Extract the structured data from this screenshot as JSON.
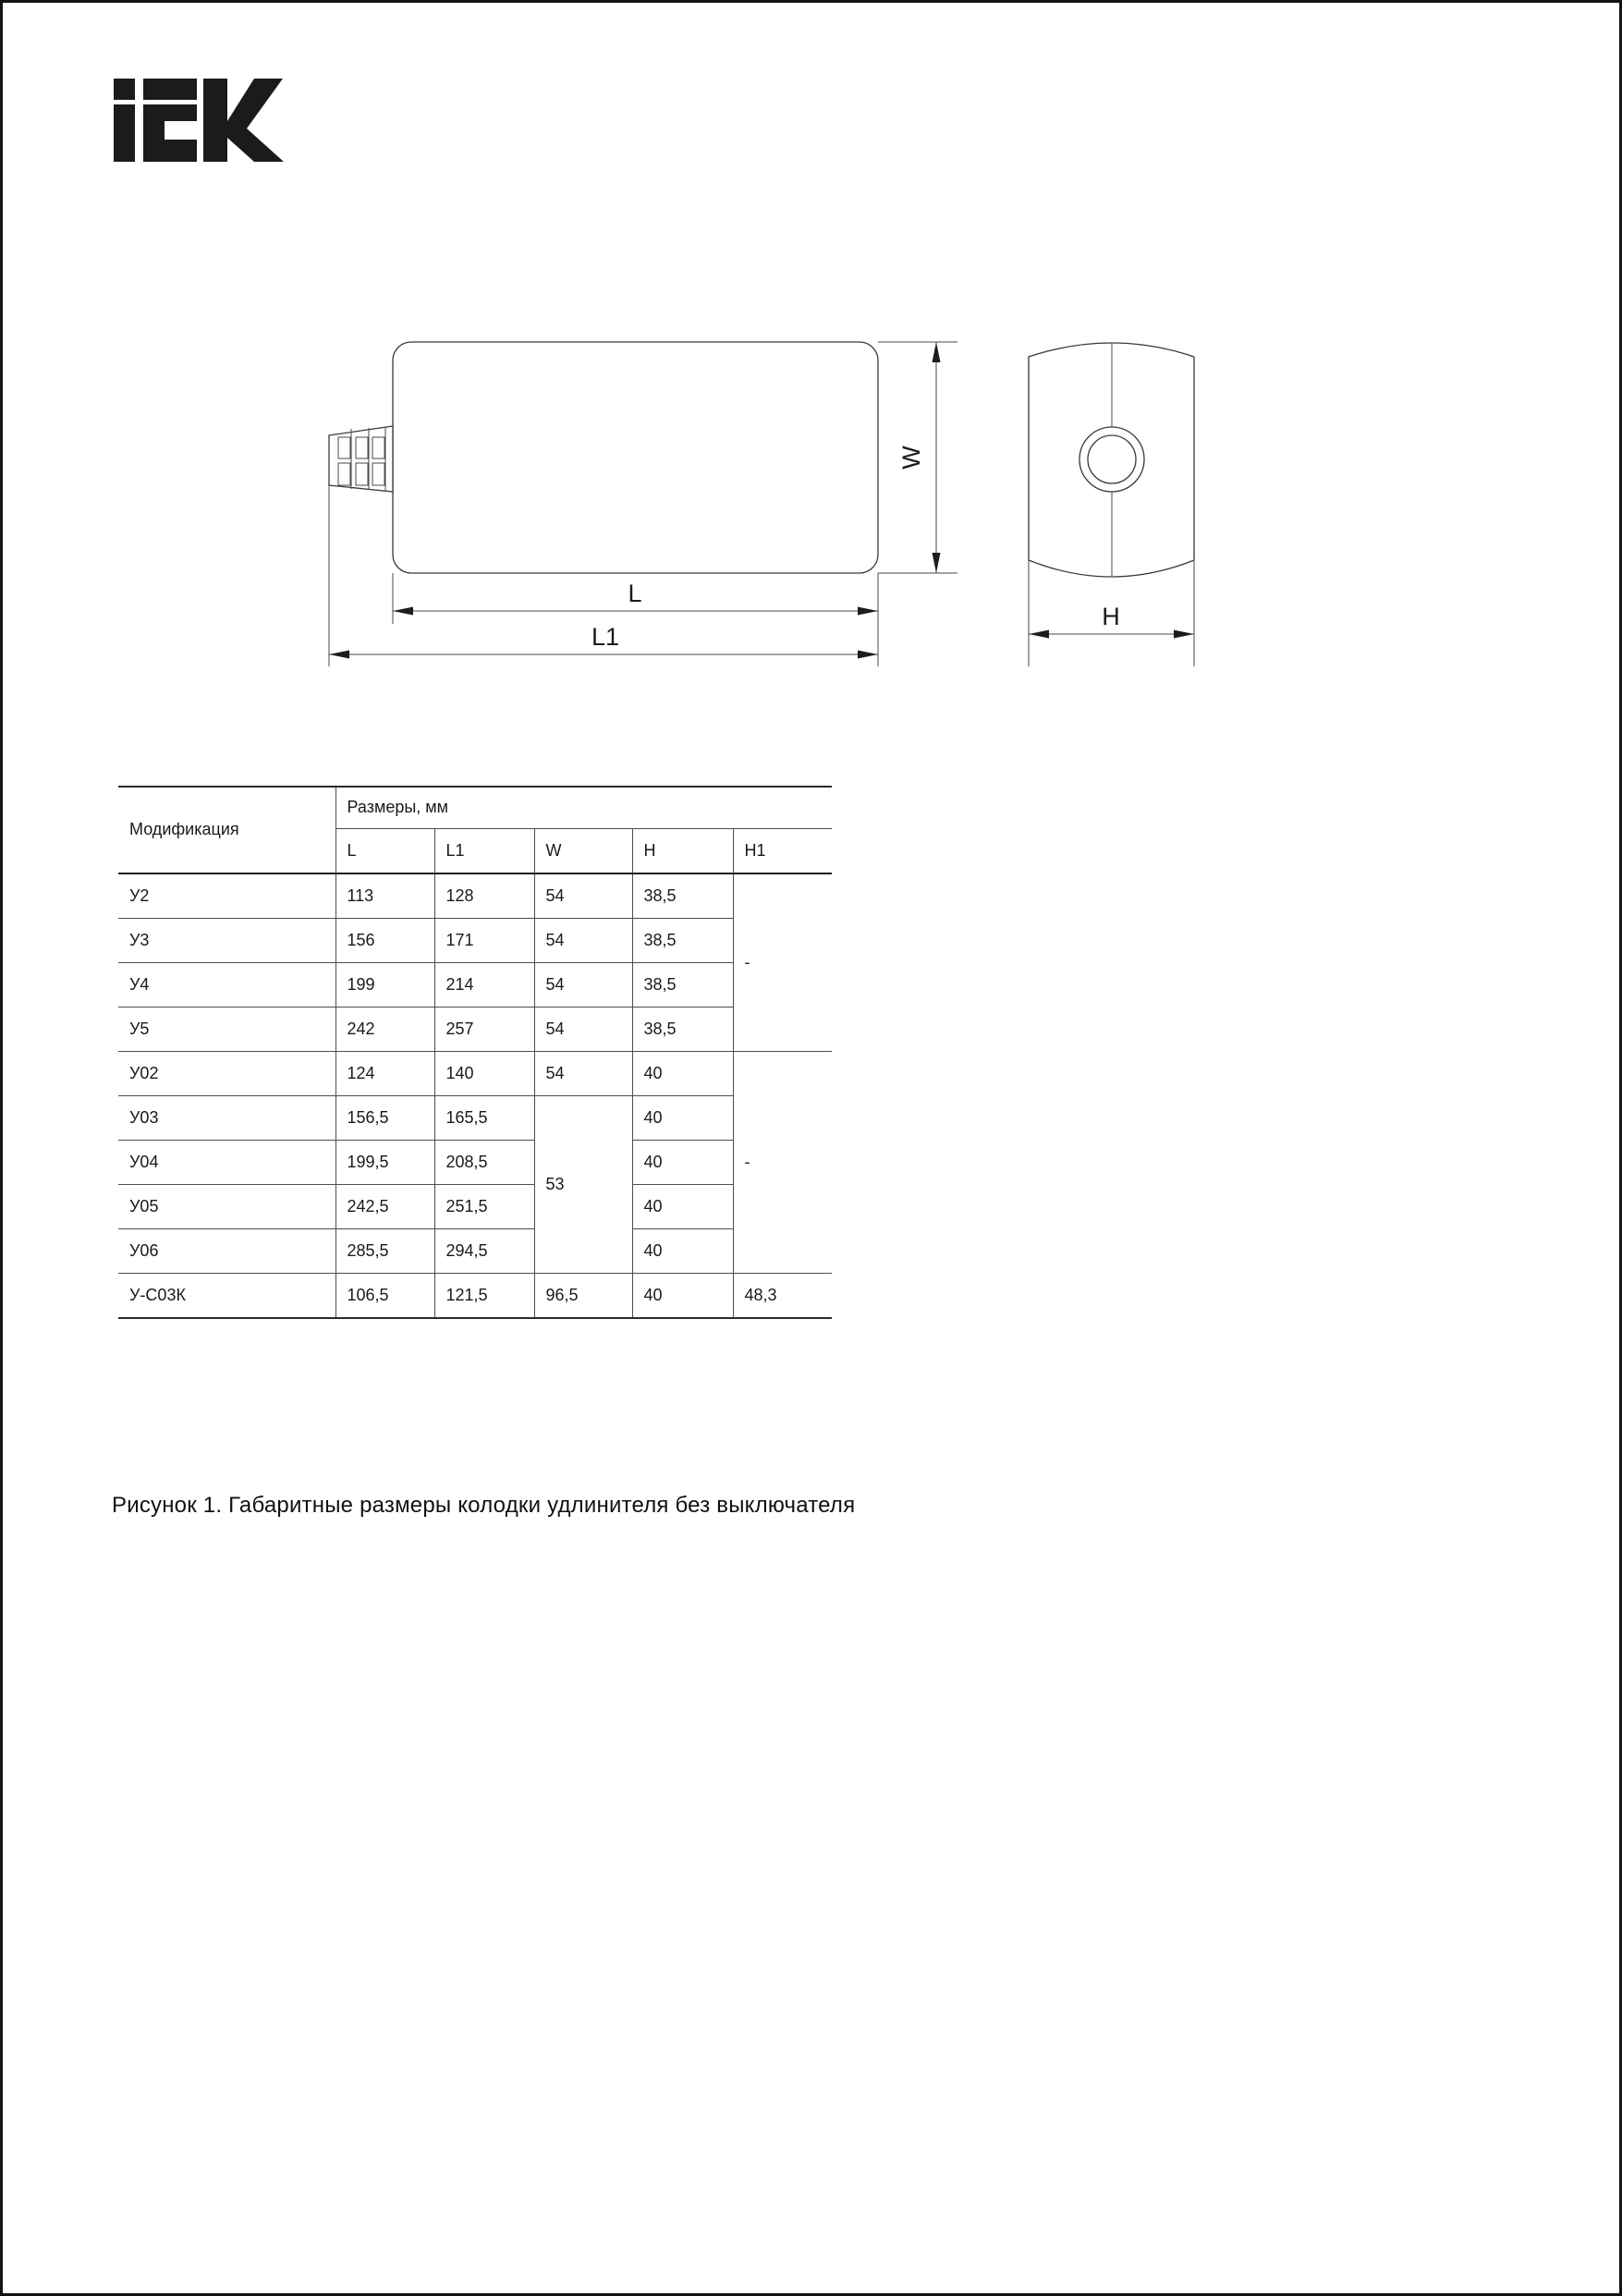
{
  "logo": {
    "brand": "IEK"
  },
  "drawing": {
    "labels": {
      "L": "L",
      "L1": "L1",
      "W": "W",
      "H": "H"
    }
  },
  "table": {
    "header": {
      "modification": "Модификация",
      "group": "Размеры, мм",
      "cols": {
        "L": "L",
        "L1": "L1",
        "W": "W",
        "H": "H",
        "H1": "H1"
      }
    },
    "rows": [
      {
        "mod": "У2",
        "L": "113",
        "L1": "128",
        "W": "54",
        "H": "38,5",
        "H1": "-"
      },
      {
        "mod": "У3",
        "L": "156",
        "L1": "171",
        "W": "54",
        "H": "38,5"
      },
      {
        "mod": "У4",
        "L": "199",
        "L1": "214",
        "W": "54",
        "H": "38,5"
      },
      {
        "mod": "У5",
        "L": "242",
        "L1": "257",
        "W": "54",
        "H": "38,5"
      },
      {
        "mod": "У02",
        "L": "124",
        "L1": "140",
        "W": "54",
        "H": "40",
        "H1": "-"
      },
      {
        "mod": "У03",
        "L": "156,5",
        "L1": "165,5",
        "W": "53",
        "H": "40"
      },
      {
        "mod": "У04",
        "L": "199,5",
        "L1": "208,5",
        "H": "40"
      },
      {
        "mod": "У05",
        "L": "242,5",
        "L1": "251,5",
        "H": "40"
      },
      {
        "mod": "У06",
        "L": "285,5",
        "L1": "294,5",
        "H": "40"
      },
      {
        "mod": "У-С03К",
        "L": "106,5",
        "L1": "121,5",
        "W": "96,5",
        "H": "40",
        "H1": "48,3"
      }
    ]
  },
  "caption": "Рисунок 1. Габаритные размеры колодки удлинителя без выключателя"
}
